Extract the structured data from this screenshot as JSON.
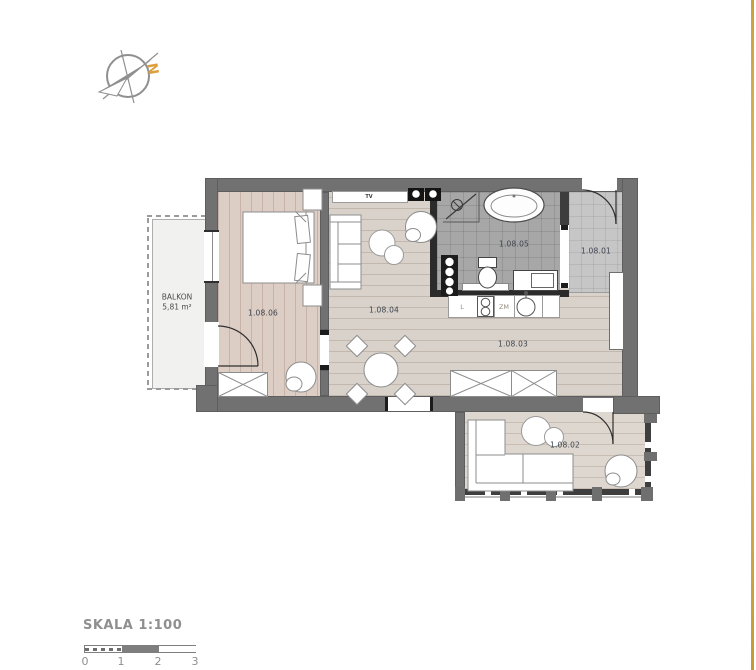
{
  "compass": {
    "north": "N"
  },
  "balcony": {
    "name": "BALKON",
    "area": "5,81 m²"
  },
  "rooms": [
    {
      "number": "1.08.01"
    },
    {
      "number": "1.08.02"
    },
    {
      "number": "1.08.03"
    },
    {
      "number": "1.08.04"
    },
    {
      "number": "1.08.05"
    },
    {
      "number": "1.08.06"
    }
  ],
  "kitchen": {
    "fridge_label": "L",
    "dishwasher_label": "ZM"
  },
  "living": {
    "tv_label": "TV"
  },
  "scalebar": {
    "title": "SKALA 1:100",
    "ticks": [
      "0",
      "1",
      "2",
      "3"
    ]
  },
  "colors": {
    "wall": "#717171",
    "bathroom_wall": "#2b2b2b",
    "accent_gold": "#c9a23f",
    "label": "#3e4450",
    "north_letter": "#dd9f3e"
  }
}
